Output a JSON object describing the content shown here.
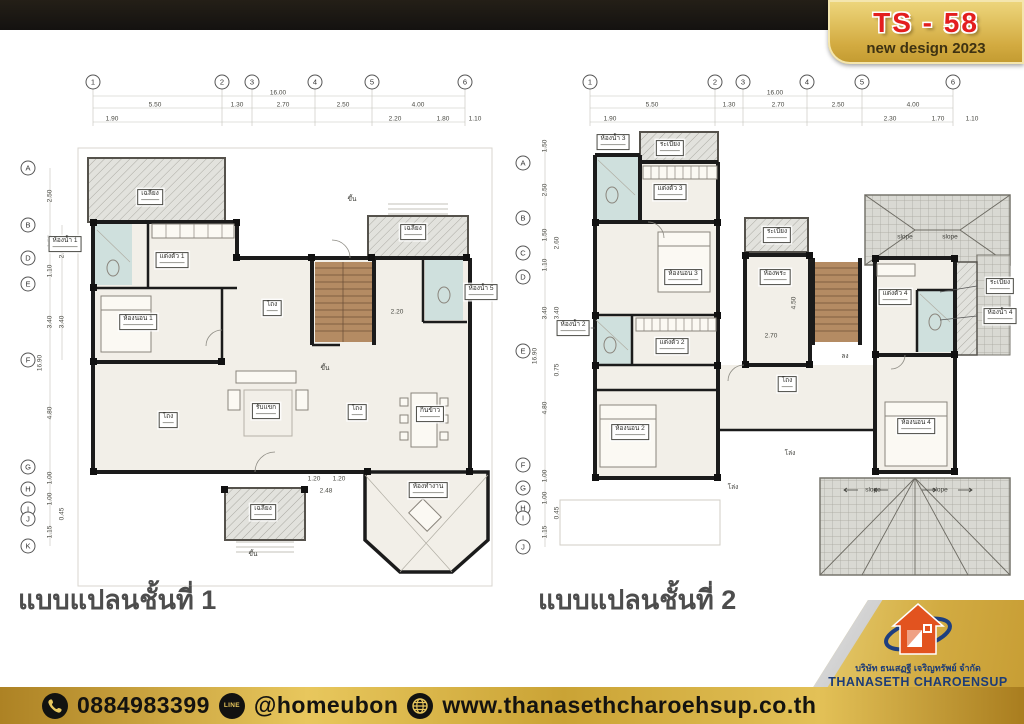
{
  "header": {
    "badge_title": "TS - 58",
    "badge_subtitle": "new design 2023"
  },
  "footer": {
    "phone": "0884983399",
    "line_id": "@homeubon",
    "website": "www.thanasethcharoehsup.co.th",
    "line_icon_text": "LINE"
  },
  "logo": {
    "company_thai": "บริษัท ธนเสฏฐี เจริญทรัพย์ จำกัด",
    "company_en": "THANASETH CHAROENSUP",
    "company_suffix": "CO., LTD."
  },
  "colors": {
    "gold": "#d2ab42",
    "badge_red": "#e31e1e",
    "navy": "#1d3c77",
    "logo_orange": "#e2531f",
    "wall": "#1b1b1b",
    "bath_blue": "#cfe0dd",
    "floor_cream": "#f2efe8",
    "stair_brown": "#b48b63"
  },
  "plans": {
    "plan1": {
      "caption": "แบบแปลนชั้นที่ 1",
      "grid_cols": [
        {
          "label": "1",
          "x": 93,
          "y": 82
        },
        {
          "label": "2",
          "x": 222,
          "y": 82
        },
        {
          "label": "3",
          "x": 252,
          "y": 82
        },
        {
          "label": "4",
          "x": 315,
          "y": 82
        },
        {
          "label": "5",
          "x": 372,
          "y": 82
        },
        {
          "label": "6",
          "x": 465,
          "y": 82
        }
      ],
      "grid_rows": [
        {
          "label": "A",
          "x": 28,
          "y": 168
        },
        {
          "label": "B",
          "x": 28,
          "y": 225
        },
        {
          "label": "D",
          "x": 28,
          "y": 258
        },
        {
          "label": "E",
          "x": 28,
          "y": 284
        },
        {
          "label": "F",
          "x": 28,
          "y": 360
        },
        {
          "label": "G",
          "x": 28,
          "y": 467
        },
        {
          "label": "H",
          "x": 28,
          "y": 489
        },
        {
          "label": "I",
          "x": 28,
          "y": 509
        },
        {
          "label": "J",
          "x": 28,
          "y": 519
        },
        {
          "label": "K",
          "x": 28,
          "y": 546
        }
      ],
      "dims": [
        {
          "label": "16.00",
          "x": 278,
          "y": 93
        },
        {
          "label": "5.50",
          "x": 155,
          "y": 105
        },
        {
          "label": "1.30",
          "x": 237,
          "y": 105
        },
        {
          "label": "2.70",
          "x": 283,
          "y": 105
        },
        {
          "label": "2.50",
          "x": 343,
          "y": 105
        },
        {
          "label": "4.00",
          "x": 418,
          "y": 105
        },
        {
          "label": "1.90",
          "x": 112,
          "y": 119
        },
        {
          "label": "2.20",
          "x": 395,
          "y": 119
        },
        {
          "label": "1.80",
          "x": 443,
          "y": 119
        },
        {
          "label": "1.10",
          "x": 475,
          "y": 119
        },
        {
          "label": "2.20",
          "x": 397,
          "y": 312
        },
        {
          "label": "1.20",
          "x": 314,
          "y": 479
        },
        {
          "label": "1.20",
          "x": 339,
          "y": 479
        },
        {
          "label": "2.48",
          "x": 326,
          "y": 491
        }
      ],
      "vdims": [
        {
          "label": "2.50",
          "x": 50,
          "y": 196
        },
        {
          "label": "1.50",
          "x": 50,
          "y": 241
        },
        {
          "label": "2.60",
          "x": 62,
          "y": 252
        },
        {
          "label": "1.10",
          "x": 50,
          "y": 271
        },
        {
          "label": "3.40",
          "x": 50,
          "y": 322
        },
        {
          "label": "3.40",
          "x": 62,
          "y": 322
        },
        {
          "label": "16.90",
          "x": 40,
          "y": 363
        },
        {
          "label": "4.80",
          "x": 50,
          "y": 413
        },
        {
          "label": "1.00",
          "x": 50,
          "y": 478
        },
        {
          "label": "1.00",
          "x": 50,
          "y": 499
        },
        {
          "label": "0.45",
          "x": 62,
          "y": 514
        },
        {
          "label": "1.15",
          "x": 50,
          "y": 532
        }
      ],
      "rooms": [
        {
          "label": "เฉลียง",
          "x": 150,
          "y": 197
        },
        {
          "label": "ห้องน้ำ 1",
          "x": 65,
          "y": 244
        },
        {
          "label": "แต่งตัว 1",
          "x": 172,
          "y": 260
        },
        {
          "label": "ห้องนอน 1",
          "x": 138,
          "y": 322
        },
        {
          "label": "โถง",
          "x": 272,
          "y": 308
        },
        {
          "label": "ห้องน้ำ 5",
          "x": 481,
          "y": 292
        },
        {
          "label": "เฉลียง",
          "x": 413,
          "y": 232
        },
        {
          "label": "โถง",
          "x": 168,
          "y": 420
        },
        {
          "label": "โถง",
          "x": 357,
          "y": 412
        },
        {
          "label": "กินข้าว",
          "x": 430,
          "y": 414
        },
        {
          "label": "รับแขก",
          "x": 266,
          "y": 411
        },
        {
          "label": "เฉลียง",
          "x": 263,
          "y": 512
        },
        {
          "label": "ห้องทำงาน",
          "x": 428,
          "y": 490
        }
      ],
      "notes": [
        {
          "label": "ขึ้น",
          "x": 352,
          "y": 199
        },
        {
          "label": "ขึ้น",
          "x": 325,
          "y": 368
        },
        {
          "label": "ขึ้น",
          "x": 253,
          "y": 554
        }
      ]
    },
    "plan2": {
      "caption": "แบบแปลนชั้นที่ 2",
      "grid_cols": [
        {
          "label": "1",
          "x": 590,
          "y": 82
        },
        {
          "label": "2",
          "x": 715,
          "y": 82
        },
        {
          "label": "3",
          "x": 743,
          "y": 82
        },
        {
          "label": "4",
          "x": 807,
          "y": 82
        },
        {
          "label": "5",
          "x": 862,
          "y": 82
        },
        {
          "label": "6",
          "x": 953,
          "y": 82
        }
      ],
      "grid_rows": [
        {
          "label": "A",
          "x": 523,
          "y": 163
        },
        {
          "label": "B",
          "x": 523,
          "y": 218
        },
        {
          "label": "C",
          "x": 523,
          "y": 253
        },
        {
          "label": "D",
          "x": 523,
          "y": 277
        },
        {
          "label": "E",
          "x": 523,
          "y": 351
        },
        {
          "label": "F",
          "x": 523,
          "y": 465
        },
        {
          "label": "G",
          "x": 523,
          "y": 488
        },
        {
          "label": "H",
          "x": 523,
          "y": 508
        },
        {
          "label": "I",
          "x": 523,
          "y": 518
        },
        {
          "label": "J",
          "x": 523,
          "y": 547
        }
      ],
      "dims": [
        {
          "label": "16.00",
          "x": 775,
          "y": 93
        },
        {
          "label": "5.50",
          "x": 652,
          "y": 105
        },
        {
          "label": "1.30",
          "x": 729,
          "y": 105
        },
        {
          "label": "2.70",
          "x": 778,
          "y": 105
        },
        {
          "label": "2.50",
          "x": 838,
          "y": 105
        },
        {
          "label": "4.00",
          "x": 913,
          "y": 105
        },
        {
          "label": "1.90",
          "x": 610,
          "y": 119
        },
        {
          "label": "2.30",
          "x": 890,
          "y": 119
        },
        {
          "label": "1.70",
          "x": 938,
          "y": 119
        },
        {
          "label": "1.10",
          "x": 972,
          "y": 119
        },
        {
          "label": "2.70",
          "x": 771,
          "y": 336
        }
      ],
      "vdims": [
        {
          "label": "1.50",
          "x": 545,
          "y": 146
        },
        {
          "label": "2.50",
          "x": 545,
          "y": 190
        },
        {
          "label": "1.50",
          "x": 545,
          "y": 235
        },
        {
          "label": "2.60",
          "x": 557,
          "y": 243
        },
        {
          "label": "1.10",
          "x": 545,
          "y": 265
        },
        {
          "label": "3.40",
          "x": 545,
          "y": 313
        },
        {
          "label": "3.40",
          "x": 557,
          "y": 313
        },
        {
          "label": "16.90",
          "x": 535,
          "y": 356
        },
        {
          "label": "0.75",
          "x": 557,
          "y": 370
        },
        {
          "label": "4.80",
          "x": 545,
          "y": 408
        },
        {
          "label": "1.00",
          "x": 545,
          "y": 476
        },
        {
          "label": "1.00",
          "x": 545,
          "y": 498
        },
        {
          "label": "0.45",
          "x": 557,
          "y": 513
        },
        {
          "label": "1.15",
          "x": 545,
          "y": 532
        },
        {
          "label": "4.50",
          "x": 794,
          "y": 303
        }
      ],
      "rooms": [
        {
          "label": "ห้องน้ำ 3",
          "x": 613,
          "y": 142
        },
        {
          "label": "ระเบียง",
          "x": 670,
          "y": 148
        },
        {
          "label": "แต่งตัว 3",
          "x": 670,
          "y": 192
        },
        {
          "label": "ระเบียง",
          "x": 777,
          "y": 235
        },
        {
          "label": "ห้องนอน 3",
          "x": 683,
          "y": 277
        },
        {
          "label": "ห้องพระ",
          "x": 775,
          "y": 277
        },
        {
          "label": "ห้องน้ำ 2",
          "x": 573,
          "y": 328
        },
        {
          "label": "แต่งตัว 2",
          "x": 672,
          "y": 346
        },
        {
          "label": "โถง",
          "x": 787,
          "y": 384
        },
        {
          "label": "แต่งตัว 4",
          "x": 895,
          "y": 297
        },
        {
          "label": "ระเบียง",
          "x": 1000,
          "y": 286
        },
        {
          "label": "ห้องน้ำ 4",
          "x": 1000,
          "y": 316
        },
        {
          "label": "ห้องนอน 4",
          "x": 916,
          "y": 426
        },
        {
          "label": "ห้องนอน 2",
          "x": 630,
          "y": 432
        }
      ],
      "notes": [
        {
          "label": "ลง",
          "x": 845,
          "y": 356
        },
        {
          "label": "โล่ง",
          "x": 790,
          "y": 453
        },
        {
          "label": "โล่ง",
          "x": 733,
          "y": 487
        },
        {
          "label": "slope",
          "x": 905,
          "y": 237
        },
        {
          "label": "slope",
          "x": 950,
          "y": 237
        },
        {
          "label": "slope",
          "x": 873,
          "y": 490
        },
        {
          "label": "slope",
          "x": 940,
          "y": 490
        }
      ]
    }
  }
}
